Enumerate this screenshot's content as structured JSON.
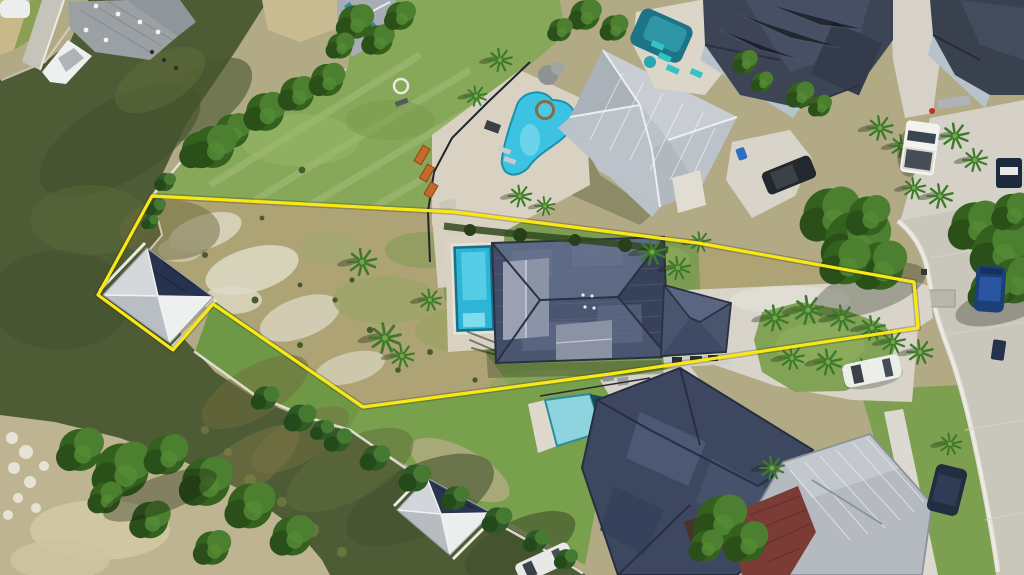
{
  "scene": {
    "type": "aerial-photo",
    "subject": "waterfront-lot-with-property-boundary",
    "boundary_points": "152,196 455,212 698,243 914,282 918,328 610,374 363,407 213,304 173,350 98,295",
    "boundary_color": "#f9e816"
  },
  "palette": {
    "water": "#4e5c35",
    "water_dark": "#41502c",
    "water_light": "#5f6c3c",
    "scrub": "#b2aa85",
    "shell": "#d9d4bf",
    "lawn": "#87a858",
    "lot_lawn": "#7e9b53",
    "grass_slope": "#79a04c",
    "verge_grass": "#7da050",
    "sand": "#c9bc92",
    "road": "#c9c6bc",
    "paver": "#d8d4ca",
    "deck": "#d9d2c2",
    "roof_main": "#55607a",
    "roof_dark_shingle": "#3d4760",
    "roof_metal": "#bcc2c9",
    "pool_blue": "#2eb4d6",
    "pool_teal": "#1d7486",
    "lanai_maroon": "#7b3c36",
    "tree_green": "#35611f",
    "palm_green": "#3e7a2c"
  }
}
